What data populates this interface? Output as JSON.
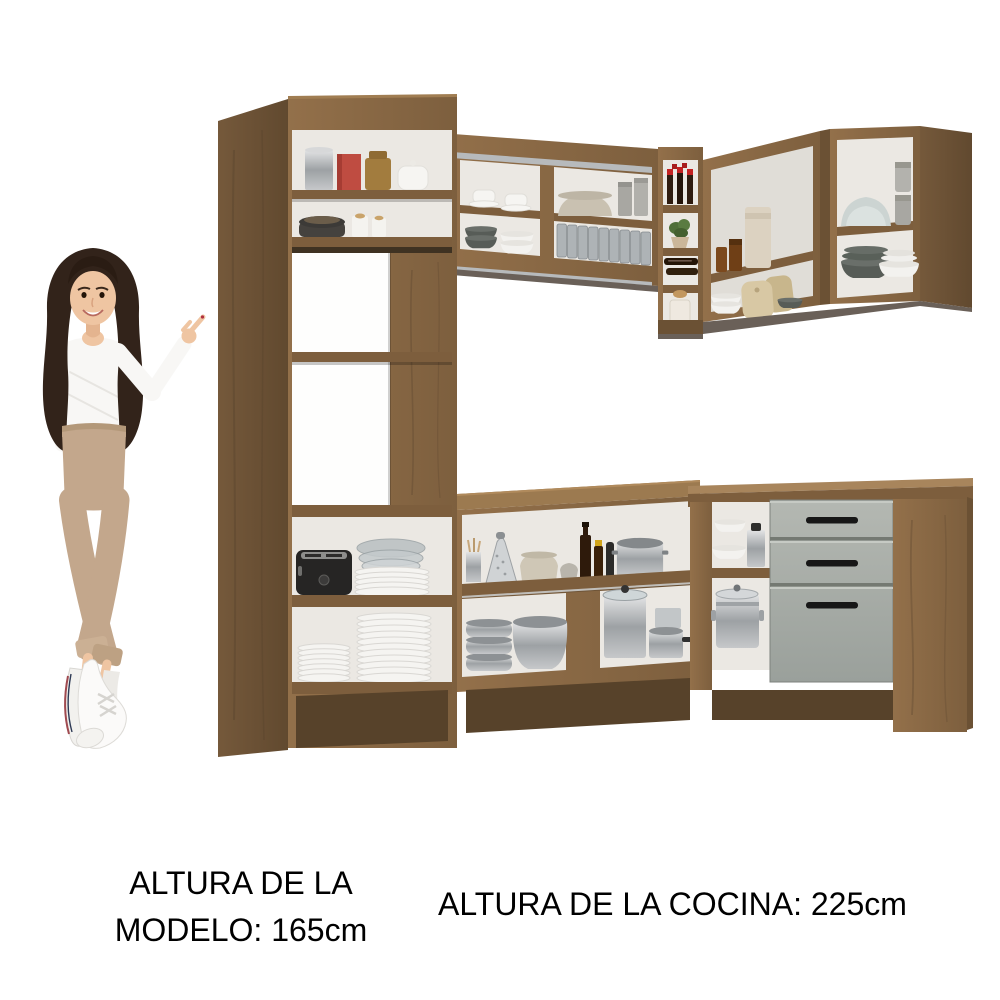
{
  "captions": {
    "model_height": {
      "line1": "ALTURA DE LA",
      "line2": "MODELO: 165cm"
    },
    "kitchen_height": "ALTURA DE LA COCINA: 225cm"
  },
  "scene": {
    "colors": {
      "background": "#ffffff",
      "wood": "#8b6a45",
      "wood_light": "#9c7a50",
      "wood_mid": "#7d5e3d",
      "wood_dark": "#6b5134",
      "wood_deep": "#57422a",
      "interior": "#ebe8e3",
      "interior_dim": "#e0ddd7",
      "alu": "#b7babc",
      "underside": "#6a6058",
      "drawer_front": "#a9aeaa",
      "drawer_handle": "#171717",
      "steel": "#b9bdc0",
      "white_dish": "#f5f4f1",
      "cream_dish": "#d2c9b8",
      "dark_bowl": "#585d58",
      "wine_cap_red": "#c32222",
      "skin": "#efc5a2",
      "hair": "#32231a",
      "sweater": "#f8f7f5",
      "pants": "#c3a78c",
      "text": "#000000"
    }
  }
}
